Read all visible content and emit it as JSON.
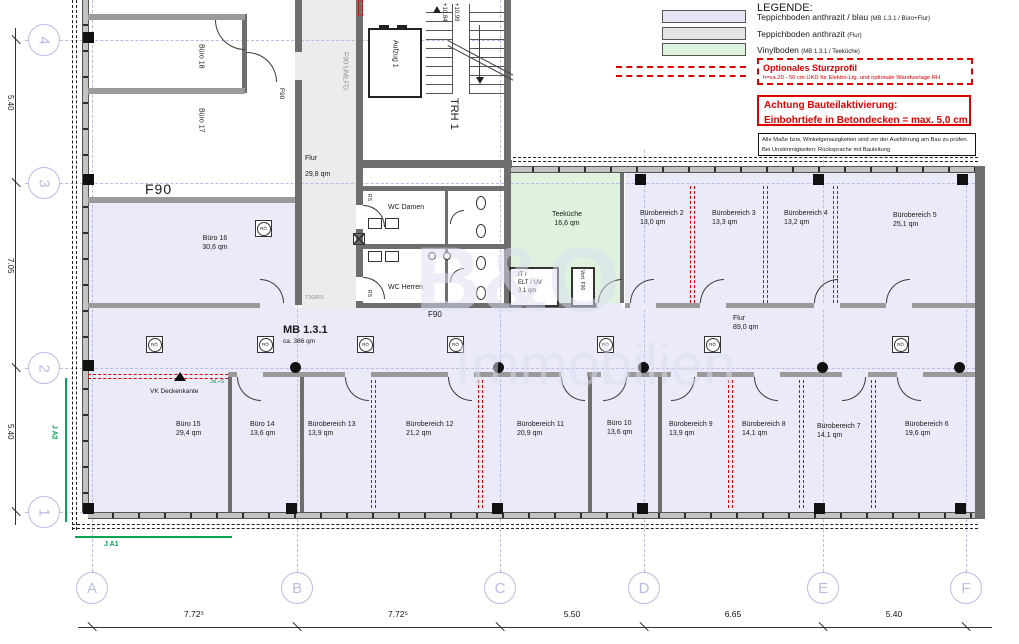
{
  "watermark": {
    "line1": "B&O",
    "line2": "Immobilien"
  },
  "legend": {
    "title": "LEGENDE:",
    "items": [
      {
        "label": "Teppichboden anthrazit / blau",
        "note": "(MB 1.3.1 / Büro+Flur)",
        "color": "#e6e6f6"
      },
      {
        "label": "Teppichboden anthrazit",
        "note": "(Flur)",
        "color": "#e4e4e4"
      },
      {
        "label": "Vinylboden",
        "note": "(MB 1.3.1 / Teeküche)",
        "color": "#dcf2dc"
      }
    ],
    "sturzprofil": {
      "title": "Optionales Sturzprofil",
      "note": "h=ca.20 - 50 cm UKD für Elektro-Ltg. und optionale Wandvorlage RH"
    },
    "warning": {
      "line1": "Achtung Bauteilaktivierung:",
      "line2": "Einbohrtiefe in Betondecken = max. 5,0 cm"
    },
    "note_box": {
      "line1": "Alle Maße bzw. Winkelgenauigkeiten sind vor der Ausführung am Bau zu prüfen.",
      "line2": "Bei Unstimmigkeiten: Rücksprache mit Bauleitung"
    }
  },
  "plan": {
    "rooms": [
      {
        "name": "Büro 18",
        "area": ""
      },
      {
        "name": "Büro 17",
        "area": ""
      },
      {
        "name": "Büro 16",
        "area": "30,6 qm"
      },
      {
        "name": "Teeküche",
        "area": "16,6 qm"
      },
      {
        "name": "Bürobereich 2",
        "area": "13,0 qm"
      },
      {
        "name": "Bürobereich 3",
        "area": "13,3 qm"
      },
      {
        "name": "Bürobereich 4",
        "area": "13,2 qm"
      },
      {
        "name": "Bürobereich 5",
        "area": "25,1 qm"
      },
      {
        "name": "Büro 15",
        "area": "29,4 qm"
      },
      {
        "name": "Büro 14",
        "area": "13,6 qm"
      },
      {
        "name": "Bürobereich 13",
        "area": "13,9 qm"
      },
      {
        "name": "Bürobereich 12",
        "area": "21,2 qm"
      },
      {
        "name": "Bürobereich 11",
        "area": "20,9 qm"
      },
      {
        "name": "Büro 10",
        "area": "13,6 qm"
      },
      {
        "name": "Bürobereich 9",
        "area": "13,9 qm"
      },
      {
        "name": "Bürobereich 8",
        "area": "14,1 qm"
      },
      {
        "name": "Bürobereich 7",
        "area": "14,1 qm"
      },
      {
        "name": "Bürobereich 6",
        "area": "19,6 qm"
      }
    ],
    "zones": {
      "mb_name": "MB 1.3.1",
      "mb_area": "ca. 386 qm",
      "flur_v_name": "Flur",
      "flur_v_area": "29,8 qm",
      "flur_h_name": "Flur",
      "flur_h_area": "89,0 qm",
      "trh": "TRH 1",
      "aufzug": "Aufzug 1",
      "umlfd": "F90 UMLFD.",
      "wc_damen": "WC Damen",
      "wc_herren": "WC Herren",
      "it_line1": "IT /",
      "it_line2": "ELT / UV",
      "it_area": "3,1 qm"
    },
    "annotations": {
      "f90_big": "F90",
      "f90_door": "F90",
      "f90_mid": "F90",
      "t30": "T30/RS",
      "vk": "VK Deckenkante",
      "jal": "Jal.+S",
      "vert": "Vert. F90",
      "ja1": "J A1",
      "ja2": "J A2",
      "level_upper": "+10,99",
      "level_lower": "+10,84",
      "ro": "RÖ",
      "rs": "RS"
    }
  },
  "grid": {
    "cols": [
      "A",
      "B",
      "C",
      "D",
      "E",
      "F"
    ],
    "col_dims": [
      "7.72⁵",
      "7.72⁵",
      "5.50",
      "6.65",
      "5.40"
    ],
    "rows": [
      "4",
      "3",
      "2",
      "1"
    ],
    "row_dims": [
      "5.40",
      "7.05",
      "5.40"
    ]
  },
  "colors": {
    "carpet_blue": "#eaeaf8",
    "carpet_gray": "#ececec",
    "vinyl_green": "#def2de",
    "wall_dark": "#6e6e6e",
    "accent_red": "#e00000",
    "grid_blue": "#b9bce9",
    "annotation_green": "#00a650"
  }
}
